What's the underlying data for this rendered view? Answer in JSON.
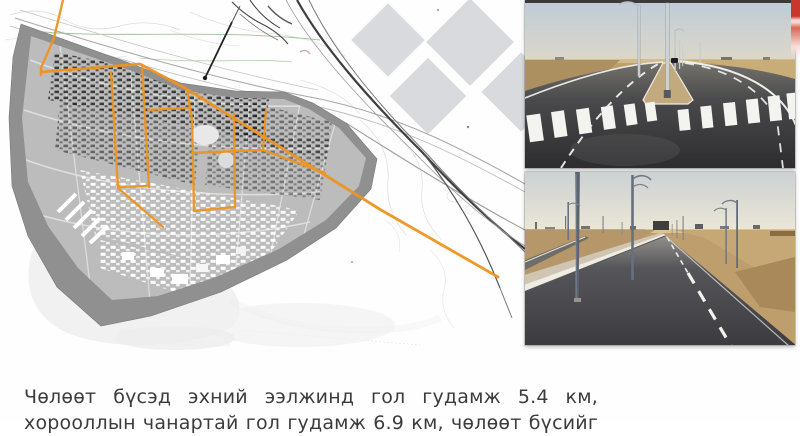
{
  "caption": {
    "line1": "Чөлөөт бүсэд эхний ээлжинд гол гудамж 5.4 км,",
    "line2": "хорооллын чанартай гол гудамж 6.9 км, чөлөөт бүсийг"
  },
  "stats": {
    "main_street_km": "5.4",
    "district_street_km": "6.9"
  },
  "figures": {
    "map": "city master plan with highlighted main street network",
    "photo_top": "new paved divided road with crosswalk in steppe",
    "photo_bottom": "straight paved road toward horizon in steppe"
  },
  "colors": {
    "accent_orange": "#EE9422",
    "ribbon_red": "#C8372D"
  }
}
